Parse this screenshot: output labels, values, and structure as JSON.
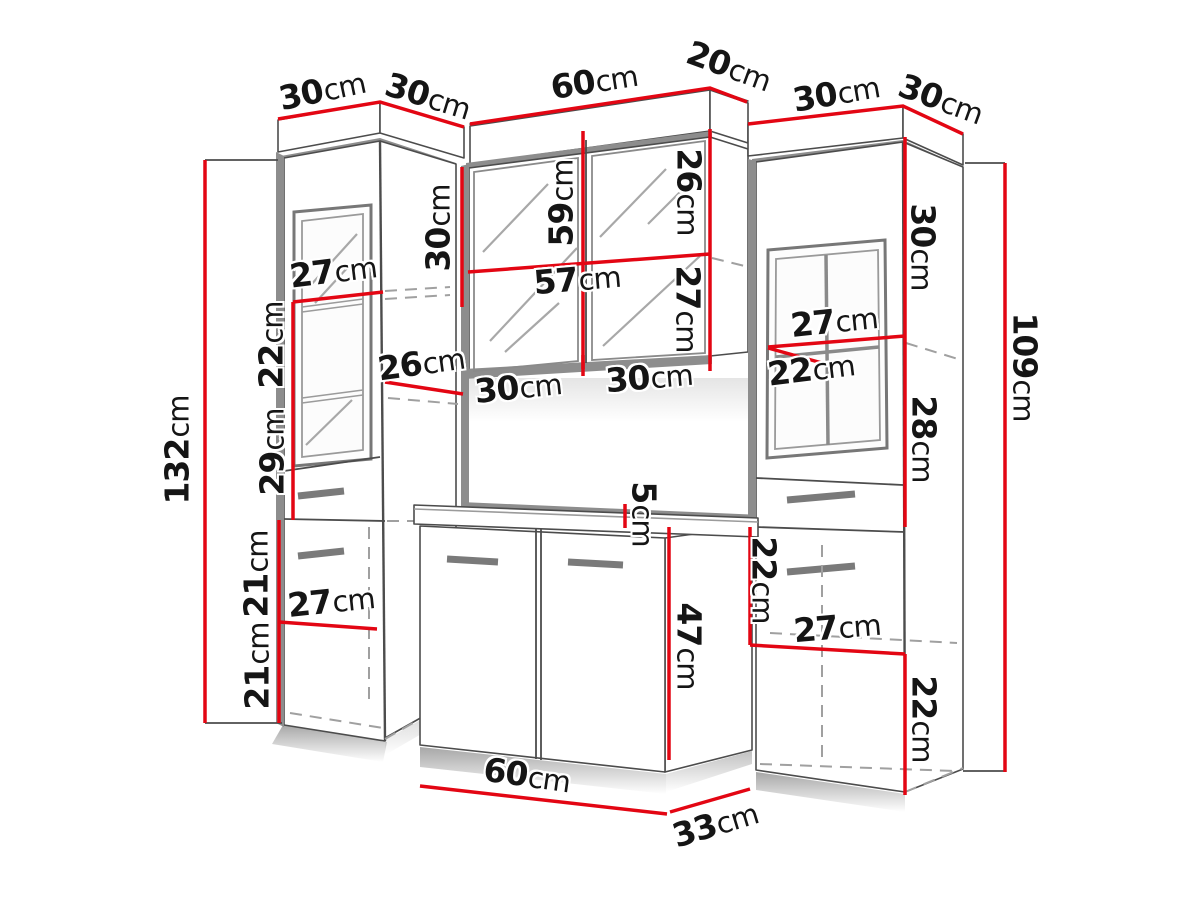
{
  "diagram": {
    "type": "furniture-dimension-diagram",
    "unit": "cm",
    "colors": {
      "accent": "#e30613",
      "line": "#4c4c4c",
      "panel_gray": "#8d8d8d",
      "background": "#ffffff",
      "text": "#151515"
    },
    "labels": [
      {
        "name": "left-cabinet-top-width",
        "value": "30",
        "unit": "cm",
        "x": 322,
        "y": 90,
        "rot": -12
      },
      {
        "name": "left-cabinet-top-depth",
        "value": "30",
        "unit": "cm",
        "x": 428,
        "y": 96,
        "rot": 17
      },
      {
        "name": "mirror-cabinet-top-width",
        "value": "60",
        "unit": "cm",
        "x": 594,
        "y": 81,
        "rot": -9
      },
      {
        "name": "mirror-cabinet-top-depth",
        "value": "20",
        "unit": "cm",
        "x": 729,
        "y": 66,
        "rot": 20
      },
      {
        "name": "right-cabinet-top-width",
        "value": "30",
        "unit": "cm",
        "x": 836,
        "y": 93,
        "rot": -10
      },
      {
        "name": "right-cabinet-top-depth",
        "value": "30",
        "unit": "cm",
        "x": 941,
        "y": 99,
        "rot": 20
      },
      {
        "name": "left-cabinet-height",
        "value": "132",
        "unit": "cm",
        "x": 177,
        "y": 450,
        "rot": -90
      },
      {
        "name": "left-shelf-width",
        "value": "27",
        "unit": "cm",
        "x": 333,
        "y": 271,
        "rot": -7
      },
      {
        "name": "left-shelf-gap-upper",
        "value": "22",
        "unit": "cm",
        "x": 271,
        "y": 345,
        "rot": -90
      },
      {
        "name": "left-shelf-gap-lower",
        "value": "29",
        "unit": "cm",
        "x": 272,
        "y": 452,
        "rot": -90
      },
      {
        "name": "left-side-shelf-depth",
        "value": "26",
        "unit": "cm",
        "x": 421,
        "y": 363,
        "rot": -8
      },
      {
        "name": "left-lower-section-upper",
        "value": "21",
        "unit": "cm",
        "x": 256,
        "y": 574,
        "rot": -90
      },
      {
        "name": "left-lower-section-lower",
        "value": "21",
        "unit": "cm",
        "x": 257,
        "y": 666,
        "rot": -90
      },
      {
        "name": "left-lower-width",
        "value": "27",
        "unit": "cm",
        "x": 331,
        "y": 601,
        "rot": -6
      },
      {
        "name": "mirror-left-side-height",
        "value": "30",
        "unit": "cm",
        "x": 438,
        "y": 228,
        "rot": -90
      },
      {
        "name": "mirror-cabinet-height",
        "value": "59",
        "unit": "cm",
        "x": 561,
        "y": 203,
        "rot": -90
      },
      {
        "name": "mirror-right-upper-height",
        "value": "26",
        "unit": "cm",
        "x": 689,
        "y": 192,
        "rot": 90
      },
      {
        "name": "mirror-inner-width",
        "value": "57",
        "unit": "cm",
        "x": 577,
        "y": 279,
        "rot": -5
      },
      {
        "name": "mirror-right-lower-height",
        "value": "27",
        "unit": "cm",
        "x": 688,
        "y": 309,
        "rot": 90
      },
      {
        "name": "mirror-door-left-width",
        "value": "30",
        "unit": "cm",
        "x": 518,
        "y": 387,
        "rot": -6
      },
      {
        "name": "mirror-door-right-width",
        "value": "30",
        "unit": "cm",
        "x": 649,
        "y": 377,
        "rot": -5
      },
      {
        "name": "right-shelf-width",
        "value": "27",
        "unit": "cm",
        "x": 834,
        "y": 321,
        "rot": -6
      },
      {
        "name": "right-shelf-gap",
        "value": "22",
        "unit": "cm",
        "x": 811,
        "y": 369,
        "rot": -7
      },
      {
        "name": "right-side-upper-height",
        "value": "30",
        "unit": "cm",
        "x": 923,
        "y": 247,
        "rot": 90
      },
      {
        "name": "right-side-middle-height",
        "value": "28",
        "unit": "cm",
        "x": 924,
        "y": 439,
        "rot": 90
      },
      {
        "name": "right-cabinet-height",
        "value": "109",
        "unit": "cm",
        "x": 1025,
        "y": 367,
        "rot": 90
      },
      {
        "name": "right-lower-front-height",
        "value": "22",
        "unit": "cm",
        "x": 764,
        "y": 580,
        "rot": 90
      },
      {
        "name": "right-lower-width",
        "value": "27",
        "unit": "cm",
        "x": 837,
        "y": 627,
        "rot": -5
      },
      {
        "name": "right-side-lower-height",
        "value": "22",
        "unit": "cm",
        "x": 924,
        "y": 719,
        "rot": 90
      },
      {
        "name": "worktop-thickness",
        "value": "5",
        "unit": "cm",
        "x": 644,
        "y": 514,
        "rot": 90
      },
      {
        "name": "vanity-height",
        "value": "47",
        "unit": "cm",
        "x": 689,
        "y": 646,
        "rot": 90
      },
      {
        "name": "vanity-width",
        "value": "60",
        "unit": "cm",
        "x": 527,
        "y": 775,
        "rot": 8
      },
      {
        "name": "vanity-depth",
        "value": "33",
        "unit": "cm",
        "x": 715,
        "y": 824,
        "rot": -17
      }
    ]
  }
}
